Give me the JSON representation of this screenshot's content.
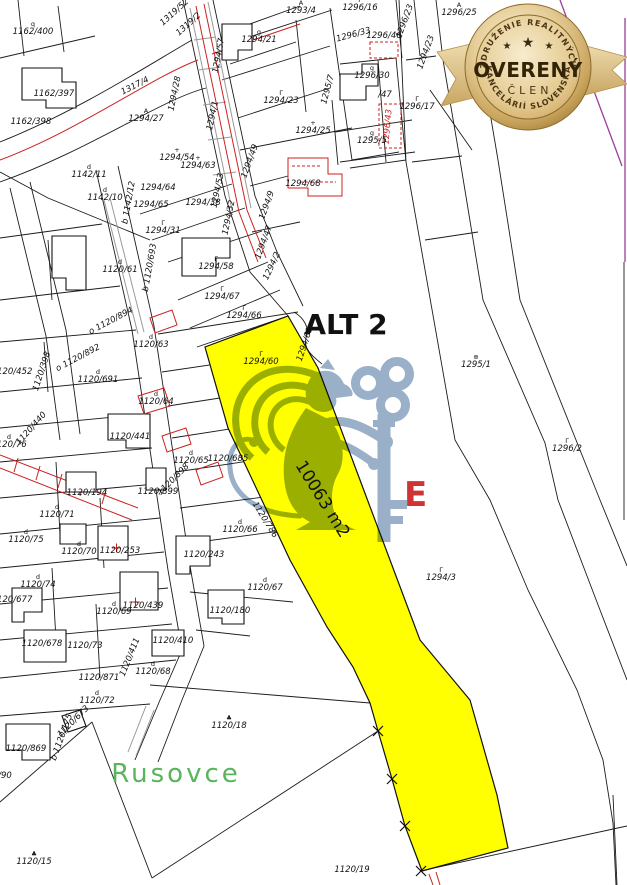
{
  "badge": {
    "top_arc": "ZDRUŽENIE REALITNÝCH",
    "bottom_arc": "KANCELÁRIÍ SLOVENSKA",
    "center": "OVERENÝ",
    "sub": "ČLEN",
    "star": "★",
    "colors": {
      "gold_dark": "#9e7a36",
      "gold_mid": "#d9b878",
      "gold_light": "#f9efd2",
      "badge_text": "#3c2b10",
      "ribbon": "#e8d3a0",
      "ribbon_dark": "#c9a763"
    }
  },
  "map": {
    "title_label": "ALT 2",
    "area_label": "10063 m2",
    "place_label": "Rusovce",
    "highlighted_parcel_number": "1294/60",
    "watermark_letter": "E",
    "colors": {
      "highlight": "#ffff00",
      "line": "#1c1c1c",
      "red": "#cc2222",
      "purple": "#9b3d9b",
      "green": "#58b55c",
      "watermark": "#8fa6c2",
      "wm_red": "#cf3333",
      "gray": "#9a9a9a"
    },
    "labels": [
      {
        "t": "1162/400",
        "x": 33,
        "y": 34,
        "sym": "q"
      },
      {
        "t": "1162/397",
        "x": 54,
        "y": 96
      },
      {
        "t": "1162/398",
        "x": 31,
        "y": 124
      },
      {
        "t": "1319/52",
        "x": 176,
        "y": 14,
        "r": -42
      },
      {
        "t": "1319/2",
        "x": 190,
        "y": 26,
        "r": -42
      },
      {
        "t": "1317/4",
        "x": 136,
        "y": 88,
        "r": -27
      },
      {
        "t": "1294/28",
        "x": 177,
        "y": 94,
        "r": -78
      },
      {
        "t": "1294/27",
        "x": 146,
        "y": 121,
        "sym": "A"
      },
      {
        "t": "1294/57",
        "x": 221,
        "y": 56,
        "r": -80
      },
      {
        "t": "1294/21",
        "x": 259,
        "y": 42,
        "sym": "g"
      },
      {
        "t": "1293/4",
        "x": 301,
        "y": 13,
        "sym": "A"
      },
      {
        "t": "1296/16",
        "x": 360,
        "y": 10,
        "sym": "Γ"
      },
      {
        "t": "1296/33",
        "x": 354,
        "y": 37,
        "r": -15
      },
      {
        "t": "1296/23",
        "x": 407,
        "y": 22,
        "r": -70
      },
      {
        "t": "1294/23",
        "x": 428,
        "y": 53,
        "r": -70
      },
      {
        "t": "1296/25",
        "x": 459,
        "y": 15,
        "sym": "A"
      },
      {
        "t": "1296/46",
        "x": 384,
        "y": 38
      },
      {
        "t": "1296/30",
        "x": 372,
        "y": 78,
        "sym": "g"
      },
      {
        "t": "1295/7",
        "x": 330,
        "y": 90,
        "r": -75
      },
      {
        "t": "/47",
        "x": 385,
        "y": 97
      },
      {
        "t": "1296/43",
        "x": 390,
        "y": 127,
        "r": -85,
        "c": "red"
      },
      {
        "t": "1296/17",
        "x": 417,
        "y": 109,
        "sym": "Γ"
      },
      {
        "t": "1294/25",
        "x": 313,
        "y": 133,
        "sym": "+"
      },
      {
        "t": "1295/5",
        "x": 372,
        "y": 143,
        "sym": "g"
      },
      {
        "t": "1294/23",
        "x": 281,
        "y": 103,
        "sym": "Γ"
      },
      {
        "t": "1294/54",
        "x": 177,
        "y": 160,
        "sym": "+"
      },
      {
        "t": "1294/63",
        "x": 198,
        "y": 168,
        "sym": "+"
      },
      {
        "t": "1294/64",
        "x": 158,
        "y": 190
      },
      {
        "t": "1294/65",
        "x": 151,
        "y": 207
      },
      {
        "t": "1294/38",
        "x": 203,
        "y": 205
      },
      {
        "t": "1294/31",
        "x": 163,
        "y": 233,
        "sym": "Γ"
      },
      {
        "t": "1294/68",
        "x": 303,
        "y": 186
      },
      {
        "t": "1294/49",
        "x": 252,
        "y": 162,
        "r": -70
      },
      {
        "t": "1294/53",
        "x": 220,
        "y": 191,
        "r": -78
      },
      {
        "t": "1294/32",
        "x": 231,
        "y": 218,
        "r": -78
      },
      {
        "t": "1294/9",
        "x": 269,
        "y": 206,
        "r": -70
      },
      {
        "t": "1294/47",
        "x": 266,
        "y": 243,
        "r": -70
      },
      {
        "t": "1294/2",
        "x": 274,
        "y": 267,
        "r": -65
      },
      {
        "t": "1294/1",
        "x": 215,
        "y": 116,
        "r": -78
      },
      {
        "t": "1142/11",
        "x": 89,
        "y": 177,
        "sym": "d"
      },
      {
        "t": "1142/10",
        "x": 105,
        "y": 200,
        "sym": "d"
      },
      {
        "t": "b 1142/12",
        "x": 131,
        "y": 203,
        "r": -80
      },
      {
        "t": "1120/61",
        "x": 120,
        "y": 272,
        "sym": "d"
      },
      {
        "t": "b 1120/693",
        "x": 152,
        "y": 268,
        "r": -80
      },
      {
        "t": "o 1120/894",
        "x": 112,
        "y": 323,
        "r": -28
      },
      {
        "t": "o 1120/892",
        "x": 79,
        "y": 360,
        "r": -28
      },
      {
        "t": "1120/398",
        "x": 44,
        "y": 372,
        "r": -72
      },
      {
        "t": "1120/452",
        "x": 12,
        "y": 374
      },
      {
        "t": "1120/63",
        "x": 151,
        "y": 347,
        "sym": "d"
      },
      {
        "t": "1120/691",
        "x": 98,
        "y": 382,
        "sym": "d"
      },
      {
        "t": "1120/64",
        "x": 156,
        "y": 404,
        "sym": "d"
      },
      {
        "t": "1120/441",
        "x": 130,
        "y": 439
      },
      {
        "t": "1120/440",
        "x": 33,
        "y": 430,
        "r": -48
      },
      {
        "t": "1120/76",
        "x": 9,
        "y": 447,
        "sym": "d"
      },
      {
        "t": "1120/65",
        "x": 191,
        "y": 463,
        "sym": "d"
      },
      {
        "t": "1120/685",
        "x": 228,
        "y": 461
      },
      {
        "t": "1120/194",
        "x": 87,
        "y": 495
      },
      {
        "t": "1120/899",
        "x": 158,
        "y": 494
      },
      {
        "t": "1120/898",
        "x": 175,
        "y": 481,
        "r": -45
      },
      {
        "t": "1120/786",
        "x": 263,
        "y": 521,
        "r": 58
      },
      {
        "t": "1120/66",
        "x": 240,
        "y": 532,
        "sym": "d"
      },
      {
        "t": "1120/243",
        "x": 204,
        "y": 557
      },
      {
        "t": "1120/71",
        "x": 57,
        "y": 517,
        "sym": "d"
      },
      {
        "t": "1120/75",
        "x": 26,
        "y": 542,
        "sym": "d"
      },
      {
        "t": "1120/70",
        "x": 79,
        "y": 554,
        "sym": "d"
      },
      {
        "t": "1120/253",
        "x": 120,
        "y": 553
      },
      {
        "t": "1120/74",
        "x": 38,
        "y": 587,
        "sym": "d"
      },
      {
        "t": "1120/677",
        "x": 12,
        "y": 602
      },
      {
        "t": "1120/69",
        "x": 114,
        "y": 614,
        "sym": "d"
      },
      {
        "t": "1120/439",
        "x": 143,
        "y": 608
      },
      {
        "t": "1120/678",
        "x": 42,
        "y": 646
      },
      {
        "t": "1120/73",
        "x": 85,
        "y": 648
      },
      {
        "t": "1120/410",
        "x": 173,
        "y": 643
      },
      {
        "t": "1120/411",
        "x": 132,
        "y": 658,
        "r": -68
      },
      {
        "t": "1120/68",
        "x": 153,
        "y": 674,
        "sym": "d"
      },
      {
        "t": "1120/871",
        "x": 99,
        "y": 680
      },
      {
        "t": "1120/67",
        "x": 265,
        "y": 590,
        "sym": "d"
      },
      {
        "t": "1120/180",
        "x": 230,
        "y": 613
      },
      {
        "t": "1120/72",
        "x": 97,
        "y": 703,
        "sym": "d"
      },
      {
        "t": "1120/673",
        "x": 75,
        "y": 723,
        "r": -45
      },
      {
        "t": "b 1120/175",
        "x": 64,
        "y": 738,
        "r": -70
      },
      {
        "t": "1120/869",
        "x": 26,
        "y": 751
      },
      {
        "t": "/90",
        "x": 5,
        "y": 778
      },
      {
        "t": "1120/18",
        "x": 229,
        "y": 728,
        "sym": "♣"
      },
      {
        "t": "1120/15",
        "x": 34,
        "y": 864,
        "sym": "♣"
      },
      {
        "t": "1120/19",
        "x": 352,
        "y": 872
      },
      {
        "t": "1294/58",
        "x": 216,
        "y": 269,
        "sym": "Γ"
      },
      {
        "t": "1294/67",
        "x": 222,
        "y": 299,
        "sym": "Γ"
      },
      {
        "t": "1294/66",
        "x": 244,
        "y": 318,
        "sym": "Γ"
      },
      {
        "t": "1294/60",
        "x": 261,
        "y": 364,
        "sym": "Γ"
      },
      {
        "t": "1294/61",
        "x": 307,
        "y": 345,
        "r": -72
      },
      {
        "t": "1295/1",
        "x": 476,
        "y": 367,
        "sym": "⊕"
      },
      {
        "t": "1296/2",
        "x": 567,
        "y": 451,
        "sym": "Γ"
      },
      {
        "t": "1294/3",
        "x": 441,
        "y": 580,
        "sym": "Γ"
      }
    ]
  }
}
